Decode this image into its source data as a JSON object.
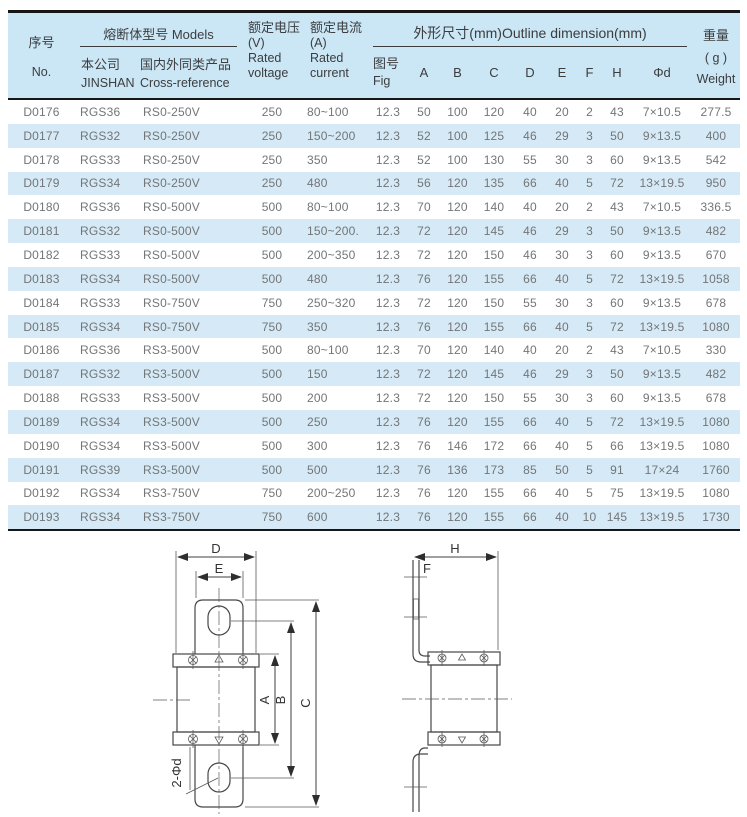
{
  "colors": {
    "header_bg": "#cbe6f4",
    "row_alt_bg": "#d5eaf6",
    "rule_dark": "#161616",
    "data_text": "#737577",
    "header_text": "#3b3d3f"
  },
  "table": {
    "header": {
      "no_zh": "序号",
      "no_en": "No.",
      "models_group": "熔断体型号 Models",
      "company_zh": "本公司",
      "company_en": "JINSHAN",
      "crossref_zh": "国内外同类产品",
      "crossref_en": "Cross-reference",
      "voltage_zh": "额定电压",
      "voltage_unit": "(V)",
      "voltage_en1": "Rated",
      "voltage_en2": "voltage",
      "current_zh": "额定电流",
      "current_unit": "(A)",
      "current_en1": "Rated",
      "current_en2": "current",
      "outline_group": "外形尺寸(mm)Outline dimension(mm)",
      "fig_zh": "图号",
      "fig_en": "Fig",
      "dim_cols": [
        "A",
        "B",
        "C",
        "D",
        "E",
        "F",
        "H",
        "Φd"
      ],
      "weight_zh": "重量",
      "weight_unit": "( g )",
      "weight_en": "Weight"
    },
    "rows": [
      [
        "D0176",
        "RGS36",
        "RS0-250V",
        "250",
        "80~100",
        "12.3",
        "50",
        "100",
        "120",
        "40",
        "20",
        "2",
        "43",
        "7×10.5",
        "277.5"
      ],
      [
        "D0177",
        "RGS32",
        "RS0-250V",
        "250",
        "150~200",
        "12.3",
        "52",
        "100",
        "125",
        "46",
        "29",
        "3",
        "50",
        "9×13.5",
        "400"
      ],
      [
        "D0178",
        "RGS33",
        "RS0-250V",
        "250",
        "350",
        "12.3",
        "52",
        "100",
        "130",
        "55",
        "30",
        "3",
        "60",
        "9×13.5",
        "542"
      ],
      [
        "D0179",
        "RGS34",
        "RS0-250V",
        "250",
        "480",
        "12.3",
        "56",
        "120",
        "135",
        "66",
        "40",
        "5",
        "72",
        "13×19.5",
        "950"
      ],
      [
        "D0180",
        "RGS36",
        "RS0-500V",
        "500",
        "80~100",
        "12.3",
        "70",
        "120",
        "140",
        "40",
        "20",
        "2",
        "43",
        "7×10.5",
        "336.5"
      ],
      [
        "D0181",
        "RGS32",
        "RS0-500V",
        "500",
        "150~200.",
        "12.3",
        "72",
        "120",
        "145",
        "46",
        "29",
        "3",
        "50",
        "9×13.5",
        "482"
      ],
      [
        "D0182",
        "RGS33",
        "RS0-500V",
        "500",
        "200~350",
        "12.3",
        "72",
        "120",
        "150",
        "46",
        "30",
        "3",
        "60",
        "9×13.5",
        "670"
      ],
      [
        "D0183",
        "RGS34",
        "RS0-500V",
        "500",
        "480",
        "12.3",
        "76",
        "120",
        "155",
        "66",
        "40",
        "5",
        "72",
        "13×19.5",
        "1058"
      ],
      [
        "D0184",
        "RGS33",
        "RS0-750V",
        "750",
        "250~320",
        "12.3",
        "72",
        "120",
        "150",
        "55",
        "30",
        "3",
        "60",
        "9×13.5",
        "678"
      ],
      [
        "D0185",
        "RGS34",
        "RS0-750V",
        "750",
        "350",
        "12.3",
        "76",
        "120",
        "155",
        "66",
        "40",
        "5",
        "72",
        "13×19.5",
        "1080"
      ],
      [
        "D0186",
        "RGS36",
        "RS3-500V",
        "500",
        "80~100",
        "12.3",
        "70",
        "120",
        "140",
        "40",
        "20",
        "2",
        "43",
        "7×10.5",
        "330"
      ],
      [
        "D0187",
        "RGS32",
        "RS3-500V",
        "500",
        "150",
        "12.3",
        "72",
        "120",
        "145",
        "46",
        "29",
        "3",
        "50",
        "9×13.5",
        "482"
      ],
      [
        "D0188",
        "RGS33",
        "RS3-500V",
        "500",
        "200",
        "12.3",
        "72",
        "120",
        "150",
        "55",
        "30",
        "3",
        "60",
        "9×13.5",
        "678"
      ],
      [
        "D0189",
        "RGS34",
        "RS3-500V",
        "500",
        "250",
        "12.3",
        "76",
        "120",
        "155",
        "66",
        "40",
        "5",
        "72",
        "13×19.5",
        "1080"
      ],
      [
        "D0190",
        "RGS34",
        "RS3-500V",
        "500",
        "300",
        "12.3",
        "76",
        "146",
        "172",
        "66",
        "40",
        "5",
        "66",
        "13×19.5",
        "1080"
      ],
      [
        "D0191",
        "RGS39",
        "RS3-500V",
        "500",
        "500",
        "12.3",
        "76",
        "136",
        "173",
        "85",
        "50",
        "5",
        "91",
        "17×24",
        "1760"
      ],
      [
        "D0192",
        "RGS34",
        "RS3-750V",
        "750",
        "200~250",
        "12.3",
        "76",
        "120",
        "155",
        "66",
        "40",
        "5",
        "75",
        "13×19.5",
        "1080"
      ],
      [
        "D0193",
        "RGS34",
        "RS3-750V",
        "750",
        "600",
        "12.3",
        "76",
        "120",
        "155",
        "66",
        "40",
        "10",
        "145",
        "13×19.5",
        "1730"
      ]
    ]
  },
  "drawings": {
    "front": {
      "d_label": "D",
      "e_label": "E",
      "a_label": "A",
      "b_label": "B",
      "c_label": "C",
      "hole_label": "2-Φd"
    },
    "side": {
      "h_label": "H",
      "f_label": "F"
    }
  }
}
